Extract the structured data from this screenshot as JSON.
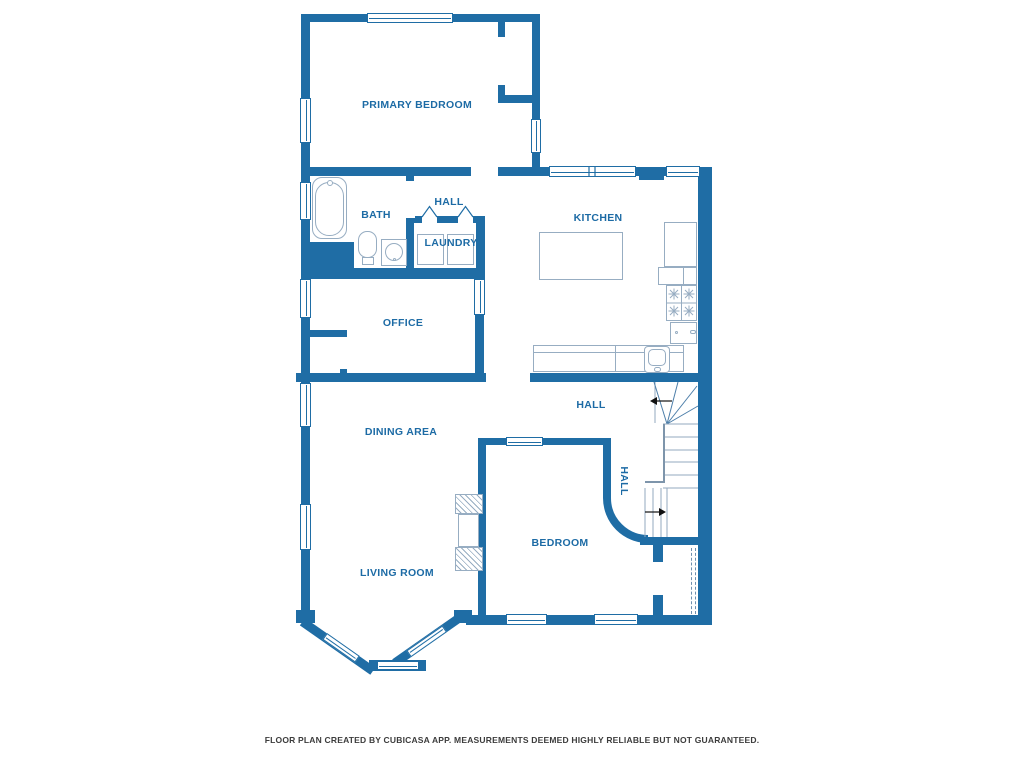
{
  "rooms": {
    "primary_bedroom": {
      "label": "PRIMARY BEDROOM"
    },
    "hall_upper": {
      "label": "HALL"
    },
    "bath": {
      "label": "BATH"
    },
    "laundry": {
      "label": "LAUNDRY"
    },
    "kitchen": {
      "label": "KITCHEN"
    },
    "office": {
      "label": "OFFICE"
    },
    "dining_area": {
      "label": "DINING AREA"
    },
    "hall_mid": {
      "label": "HALL"
    },
    "hall_stair": {
      "label": "HALL"
    },
    "bedroom": {
      "label": "BEDROOM"
    },
    "living_room": {
      "label": "LIVING ROOM"
    }
  },
  "footer": {
    "disclaimer": "FLOOR PLAN CREATED BY CUBICASA APP. MEASUREMENTS DEEMED HIGHLY RELIABLE BUT NOT GUARANTEED."
  },
  "colors": {
    "wall": "#1f6da5",
    "fixture": "#97adc2",
    "stair_line": "#93a9bf",
    "fan_line": "#4c7ea9",
    "label_text": "#1d6ba5",
    "footer_text": "#3c3c3c",
    "arrow": "#111111",
    "dash": "#6e8fae"
  }
}
